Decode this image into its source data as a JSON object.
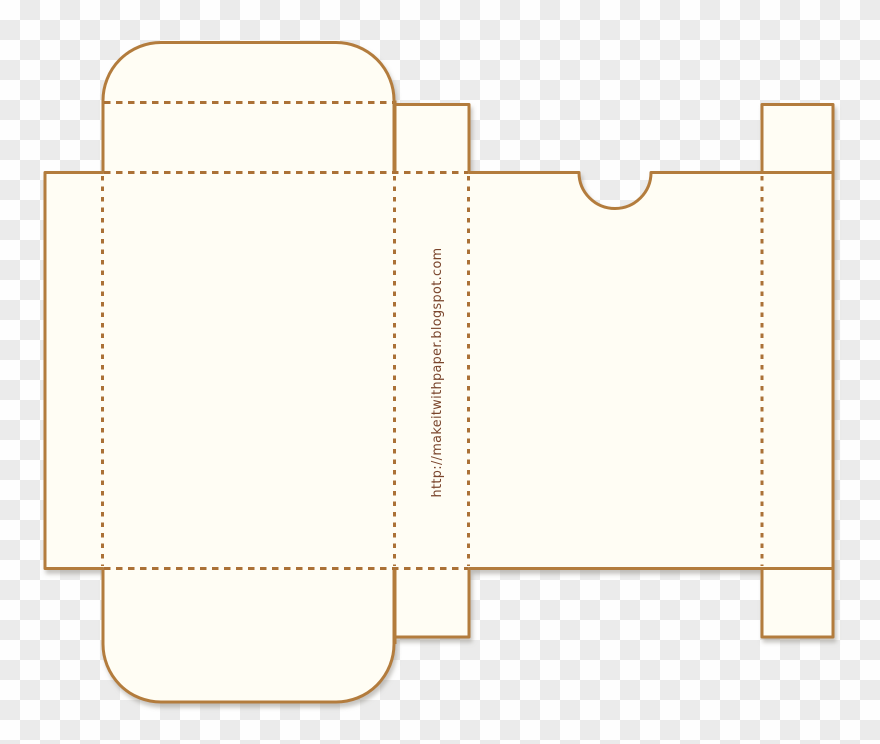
{
  "watermark": {
    "text": "http://makeitwithpaper.blogspot.com"
  },
  "colors": {
    "cut_line": "#b37c3c",
    "fold_line": "#ab7136",
    "paper_fill": "#fffdf4",
    "watermark_text": "#7a452c",
    "checker_light": "#fefefe",
    "checker_dark": "#ebebeb",
    "shadow": "#8f8a82"
  }
}
